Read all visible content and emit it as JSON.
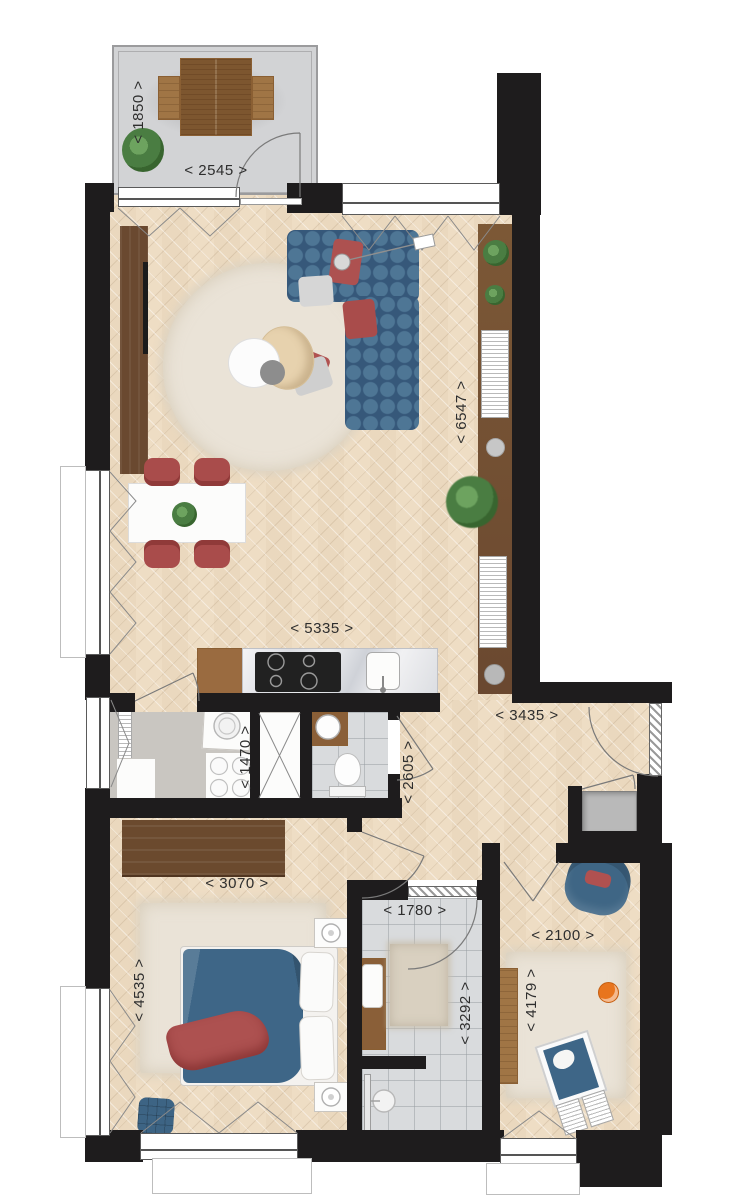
{
  "plan": {
    "type": "apartment-floor-plan-top-view",
    "dims": {
      "balcony_depth": "< 1850 >",
      "balcony_width": "< 2545 >",
      "living_height": "< 6547 >",
      "living_width": "< 5335 >",
      "hallway_width": "< 3435 >",
      "utility_width": "< 1470 >",
      "hallway_height": "< 2605 >",
      "bedroom_width": "< 3070 >",
      "bedroom_height": "< 4535 >",
      "bathroom_width": "< 1780 >",
      "bathroom_height": "< 3292 >",
      "bedroom2_width": "< 2100 >",
      "bedroom2_height": "< 4179 >"
    },
    "colors": {
      "wall": "#1e1c1d",
      "wood_floor": "#eeddc4",
      "balcony_floor": "#d2d3d5",
      "tile_floor": "#d9dbdd",
      "utility_floor": "#c9c6c1",
      "sofa_blue": "#3f6586",
      "accent_terracotta": "#ad5150",
      "rug_cream": "#eae3d7",
      "furniture_wood_dark": "#6b4a2e",
      "furniture_wood_mid": "#a07545",
      "marble_counter": "#e9eaec",
      "dimension_text": "#2e2e2e"
    }
  }
}
